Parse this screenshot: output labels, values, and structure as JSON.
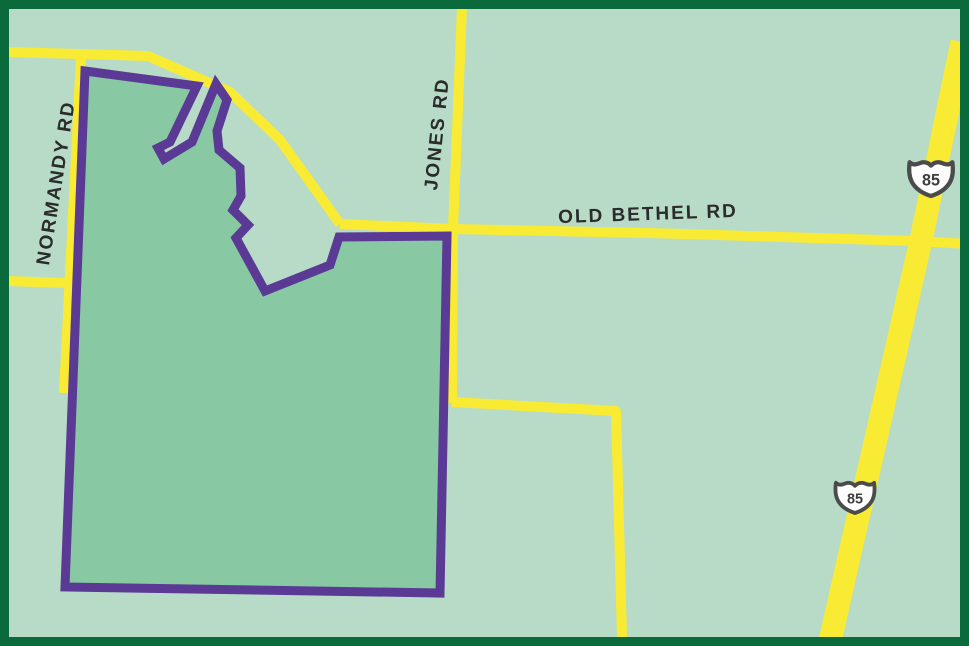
{
  "labels": {
    "normandy": {
      "text": "NORMANDY RD",
      "x": 57,
      "y": 183,
      "rotation": -81
    },
    "jones": {
      "text": "JONES RD",
      "x": 438,
      "y": 134,
      "rotation": -84
    },
    "old_bethel": {
      "text": "OLD BETHEL RD",
      "x": 648,
      "y": 215,
      "rotation": -2
    }
  },
  "highway_shields": [
    {
      "label": "85",
      "x": 931,
      "y": 177,
      "scale": 0.95
    },
    {
      "label": "85",
      "x": 855,
      "y": 496,
      "scale": 0.85
    }
  ],
  "colors": {
    "background": "#b7dbc7",
    "parcel_fill": "#88c9a3",
    "parcel_outline": "#5a3a95",
    "road": "#f9eb33",
    "border": "#0b6a3b",
    "label_text": "#2b2b2b",
    "shield_outline": "#4b4b4b",
    "shield_fill": "#fdfdfd",
    "shield_text": "#3d3d3d"
  },
  "roads": [
    {
      "name": "north-road",
      "width": 10,
      "points": [
        [
          7,
          52
        ],
        [
          148,
          56
        ],
        [
          230,
          92
        ],
        [
          280,
          140
        ],
        [
          340,
          224
        ]
      ]
    },
    {
      "name": "old-bethel-rd",
      "width": 10,
      "points": [
        [
          340,
          224
        ],
        [
          453,
          229
        ],
        [
          650,
          233
        ],
        [
          915,
          241
        ],
        [
          969,
          244
        ]
      ]
    },
    {
      "name": "normandy-rd",
      "width": 10,
      "points": [
        [
          81,
          55
        ],
        [
          64,
          393
        ]
      ]
    },
    {
      "name": "normandy-stub",
      "width": 10,
      "points": [
        [
          7,
          281
        ],
        [
          66,
          283
        ]
      ]
    },
    {
      "name": "jones-rd",
      "width": 10,
      "points": [
        [
          462,
          7
        ],
        [
          453,
          229
        ],
        [
          452,
          403
        ]
      ]
    },
    {
      "name": "east-branch",
      "width": 10,
      "points": [
        [
          452,
          402
        ],
        [
          616,
          411
        ],
        [
          622,
          638
        ]
      ]
    },
    {
      "name": "highway-85",
      "width": 23,
      "points": [
        [
          962,
          42
        ],
        [
          921,
          240
        ],
        [
          830,
          641
        ]
      ]
    }
  ],
  "parcel": {
    "outline_width": 9,
    "points": [
      [
        85,
        71
      ],
      [
        197,
        86
      ],
      [
        170,
        142
      ],
      [
        158,
        148
      ],
      [
        164,
        159
      ],
      [
        192,
        142
      ],
      [
        216,
        84
      ],
      [
        227,
        100
      ],
      [
        217,
        131
      ],
      [
        219,
        150
      ],
      [
        240,
        168
      ],
      [
        241,
        196
      ],
      [
        233,
        210
      ],
      [
        248,
        225
      ],
      [
        236,
        238
      ],
      [
        265,
        291
      ],
      [
        330,
        265
      ],
      [
        339,
        237
      ],
      [
        447,
        236
      ],
      [
        440,
        593
      ],
      [
        65,
        587
      ]
    ]
  },
  "border": {
    "width": 9
  }
}
